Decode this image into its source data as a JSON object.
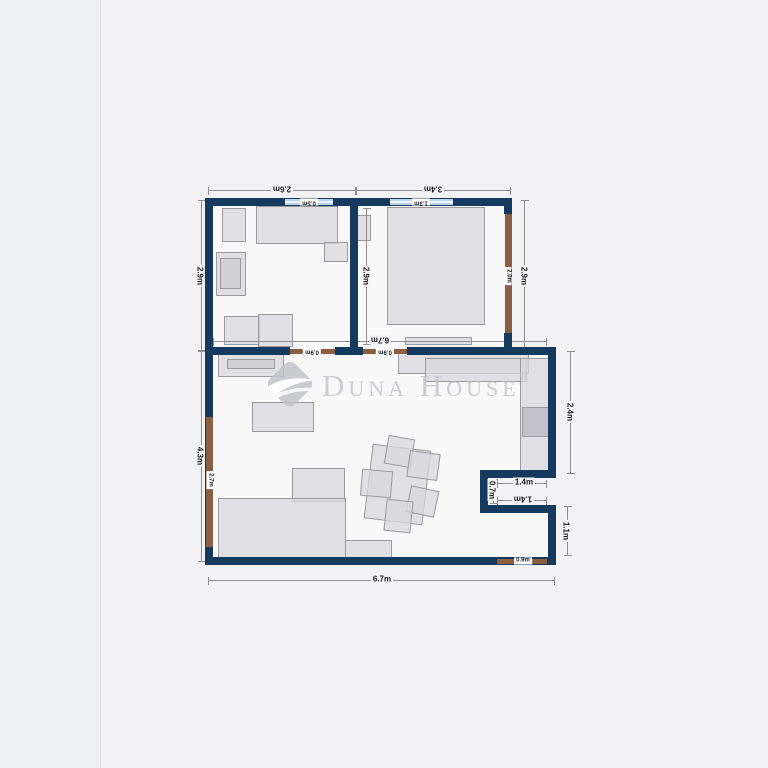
{
  "watermark": {
    "brand": "Duna House",
    "registered": "®"
  },
  "dims": {
    "top_left": "2.6m",
    "top_right": "3.4m",
    "window_left": "0.5m",
    "window_right": "1.3m",
    "side_left_upper": "2.9m",
    "side_left_lower": "4.3m",
    "left_opening": "2.7m",
    "mid_vertical": "2.9m",
    "right_opening": "2.0m",
    "side_right_upper": "2.9m",
    "interior_width": "6.7m",
    "door_left": "0.9m",
    "door_right": "0.9m",
    "side_right_living": "2.4m",
    "notch_width_top": "1.4m",
    "notch_height": "0.7m",
    "notch_width_bottom": "1.4m",
    "side_right_lower": "1.1m",
    "door_bottom": "0.9m",
    "bottom_width": "6.7m"
  },
  "colors": {
    "wall": "#16395f",
    "door_opening": "#8a5f41",
    "window": "#b9d3e8",
    "floor": "#f8f8f9",
    "background": "#f2f2f4",
    "furniture": "#d8d8dc",
    "watermark": "#c5c6c9"
  }
}
